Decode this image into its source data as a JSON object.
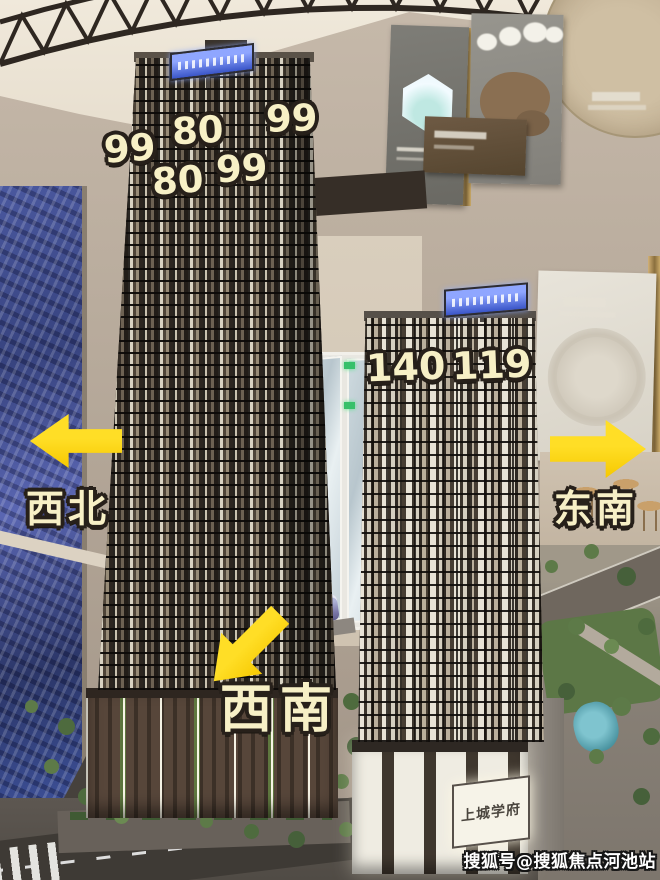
{
  "annotations": {
    "left_tower_floor_counts": [
      "99",
      "80",
      "99",
      "80",
      "99"
    ],
    "right_tower_floor_counts": [
      "140",
      "119"
    ],
    "directions": {
      "northwest": "西北",
      "southeast": "东南",
      "southwest": "西南"
    }
  },
  "model": {
    "podium_sign_text": "上城学府"
  },
  "watermark": {
    "text": "搜狐号@搜狐焦点河池站"
  },
  "colors": {
    "annotation_fill": "#f7f0c6",
    "annotation_outline": "#27201a",
    "arrow_yellow": "#ffd60a",
    "led_screen_blue": "#3c4f96",
    "ceiling_cream": "#ece4d6",
    "wall_tan": "#b7aa9b",
    "tower_dark_brown": "#2b251f",
    "tree_green": "#5d7a48"
  }
}
